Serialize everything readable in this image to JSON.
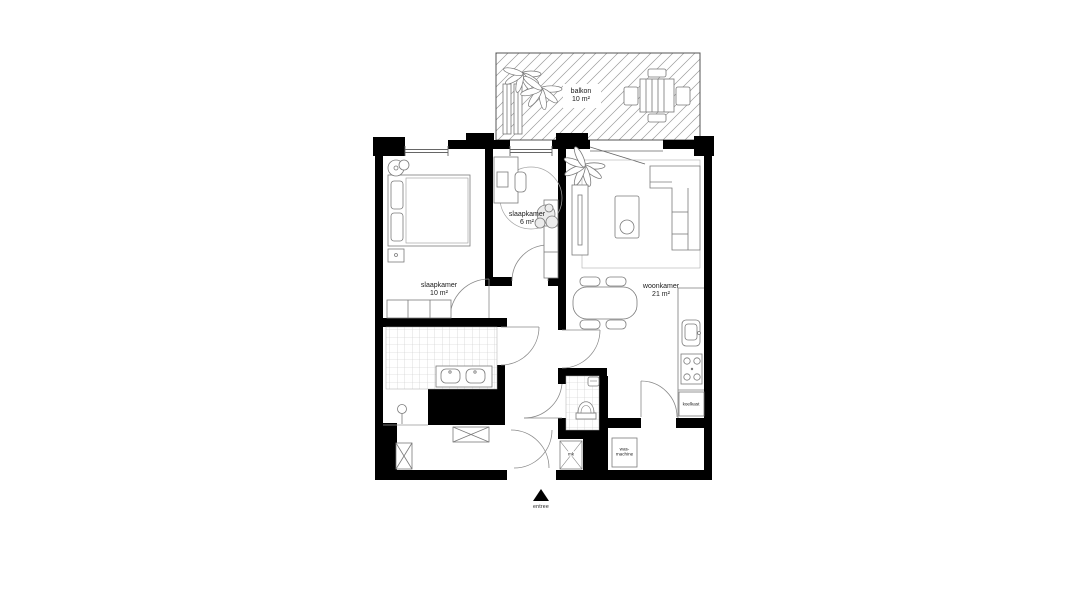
{
  "rooms": {
    "balcony": {
      "name": "balkon",
      "area": "10 m²"
    },
    "bedroom_small": {
      "name": "slaapkamer",
      "area": "6 m²"
    },
    "bedroom_large": {
      "name": "slaapkamer",
      "area": "10 m²"
    },
    "living_room": {
      "name": "woonkamer",
      "area": "21 m²"
    }
  },
  "fixtures": {
    "fridge": "koelkast",
    "meter_cupboard": "mk",
    "washing_machine_line1": "was-",
    "washing_machine_line2": "machine",
    "entrance": "entree"
  },
  "colors": {
    "walls": "#000000",
    "furniture_lines": "#7b7b7b",
    "hatch": "#9b9b9b",
    "tiles": "#c8c8c8",
    "text": "#1b1b1b",
    "background": "#ffffff"
  }
}
